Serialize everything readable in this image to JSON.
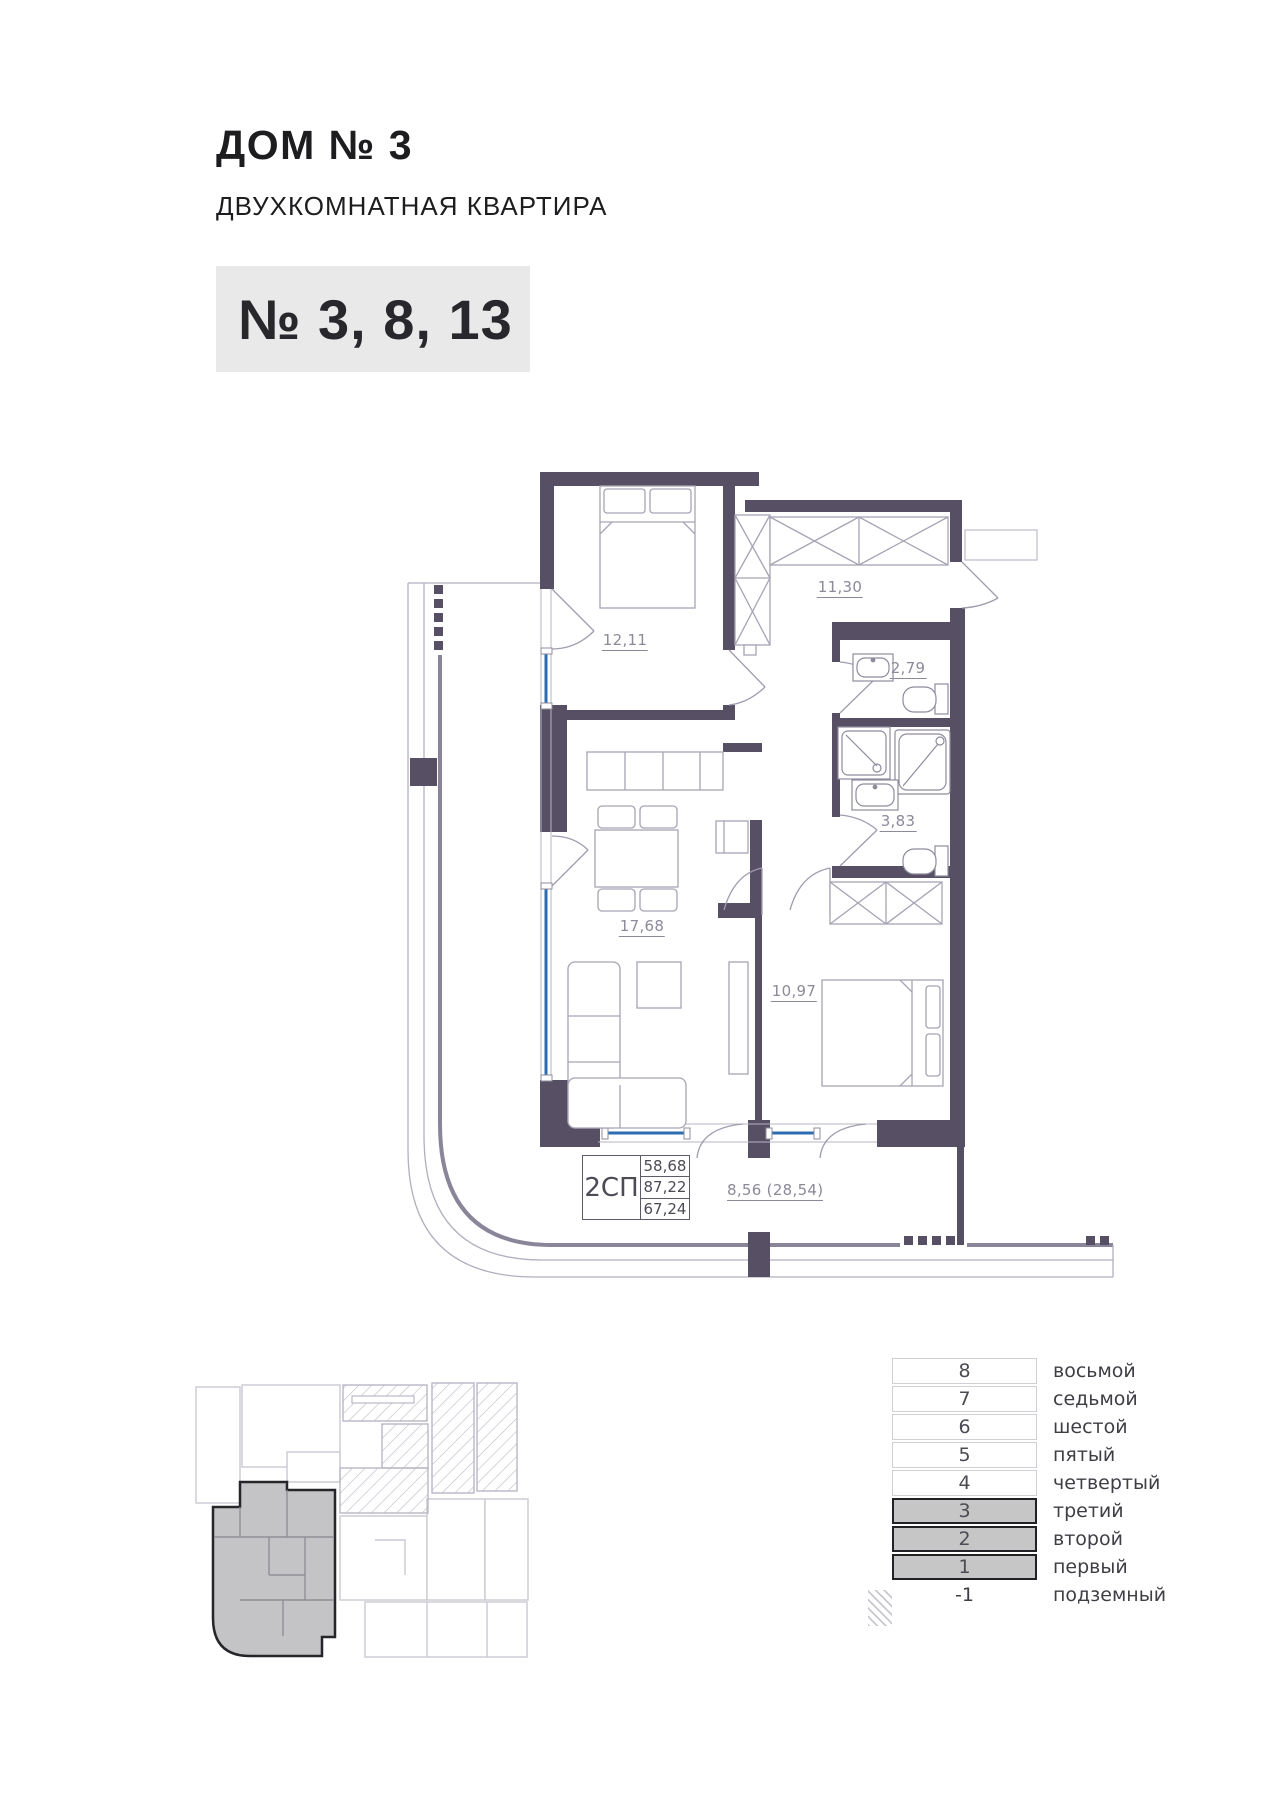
{
  "header": {
    "house": "ДОМ № 3",
    "apartment_type": "ДВУХКОМНАТНАЯ КВАРТИРА",
    "unit_numbers": "№ 3, 8, 13"
  },
  "plan": {
    "room_areas": {
      "bedroom_1": "12,11",
      "hallway": "11,30",
      "bathroom_small": "2,79",
      "bathroom_large": "3,83",
      "living_kitchen": "17,68",
      "bedroom_2": "10,97"
    },
    "info_box": {
      "type": "2СП",
      "values": [
        "58,68",
        "87,22",
        "67,24"
      ]
    },
    "balcony_note": "8,56 (28,54)"
  },
  "floor_table": {
    "rows": [
      {
        "num": "8",
        "label": "восьмой",
        "highlight": false
      },
      {
        "num": "7",
        "label": "седьмой",
        "highlight": false
      },
      {
        "num": "6",
        "label": "шестой",
        "highlight": false
      },
      {
        "num": "5",
        "label": "пятый",
        "highlight": false
      },
      {
        "num": "4",
        "label": "четвертый",
        "highlight": false
      },
      {
        "num": "3",
        "label": "третий",
        "highlight": true
      },
      {
        "num": "2",
        "label": "второй",
        "highlight": true
      },
      {
        "num": "1",
        "label": "первый",
        "highlight": true
      },
      {
        "num": "-1",
        "label": "подземный",
        "highlight": false
      }
    ]
  },
  "colors": {
    "wall": "#575064",
    "window": "#2e6cb2",
    "badge_bg": "#e9e9e9",
    "highlight_row": "#c6c6c6",
    "label_gray": "#8d8999",
    "site_highlight": "#c4c4c6"
  }
}
